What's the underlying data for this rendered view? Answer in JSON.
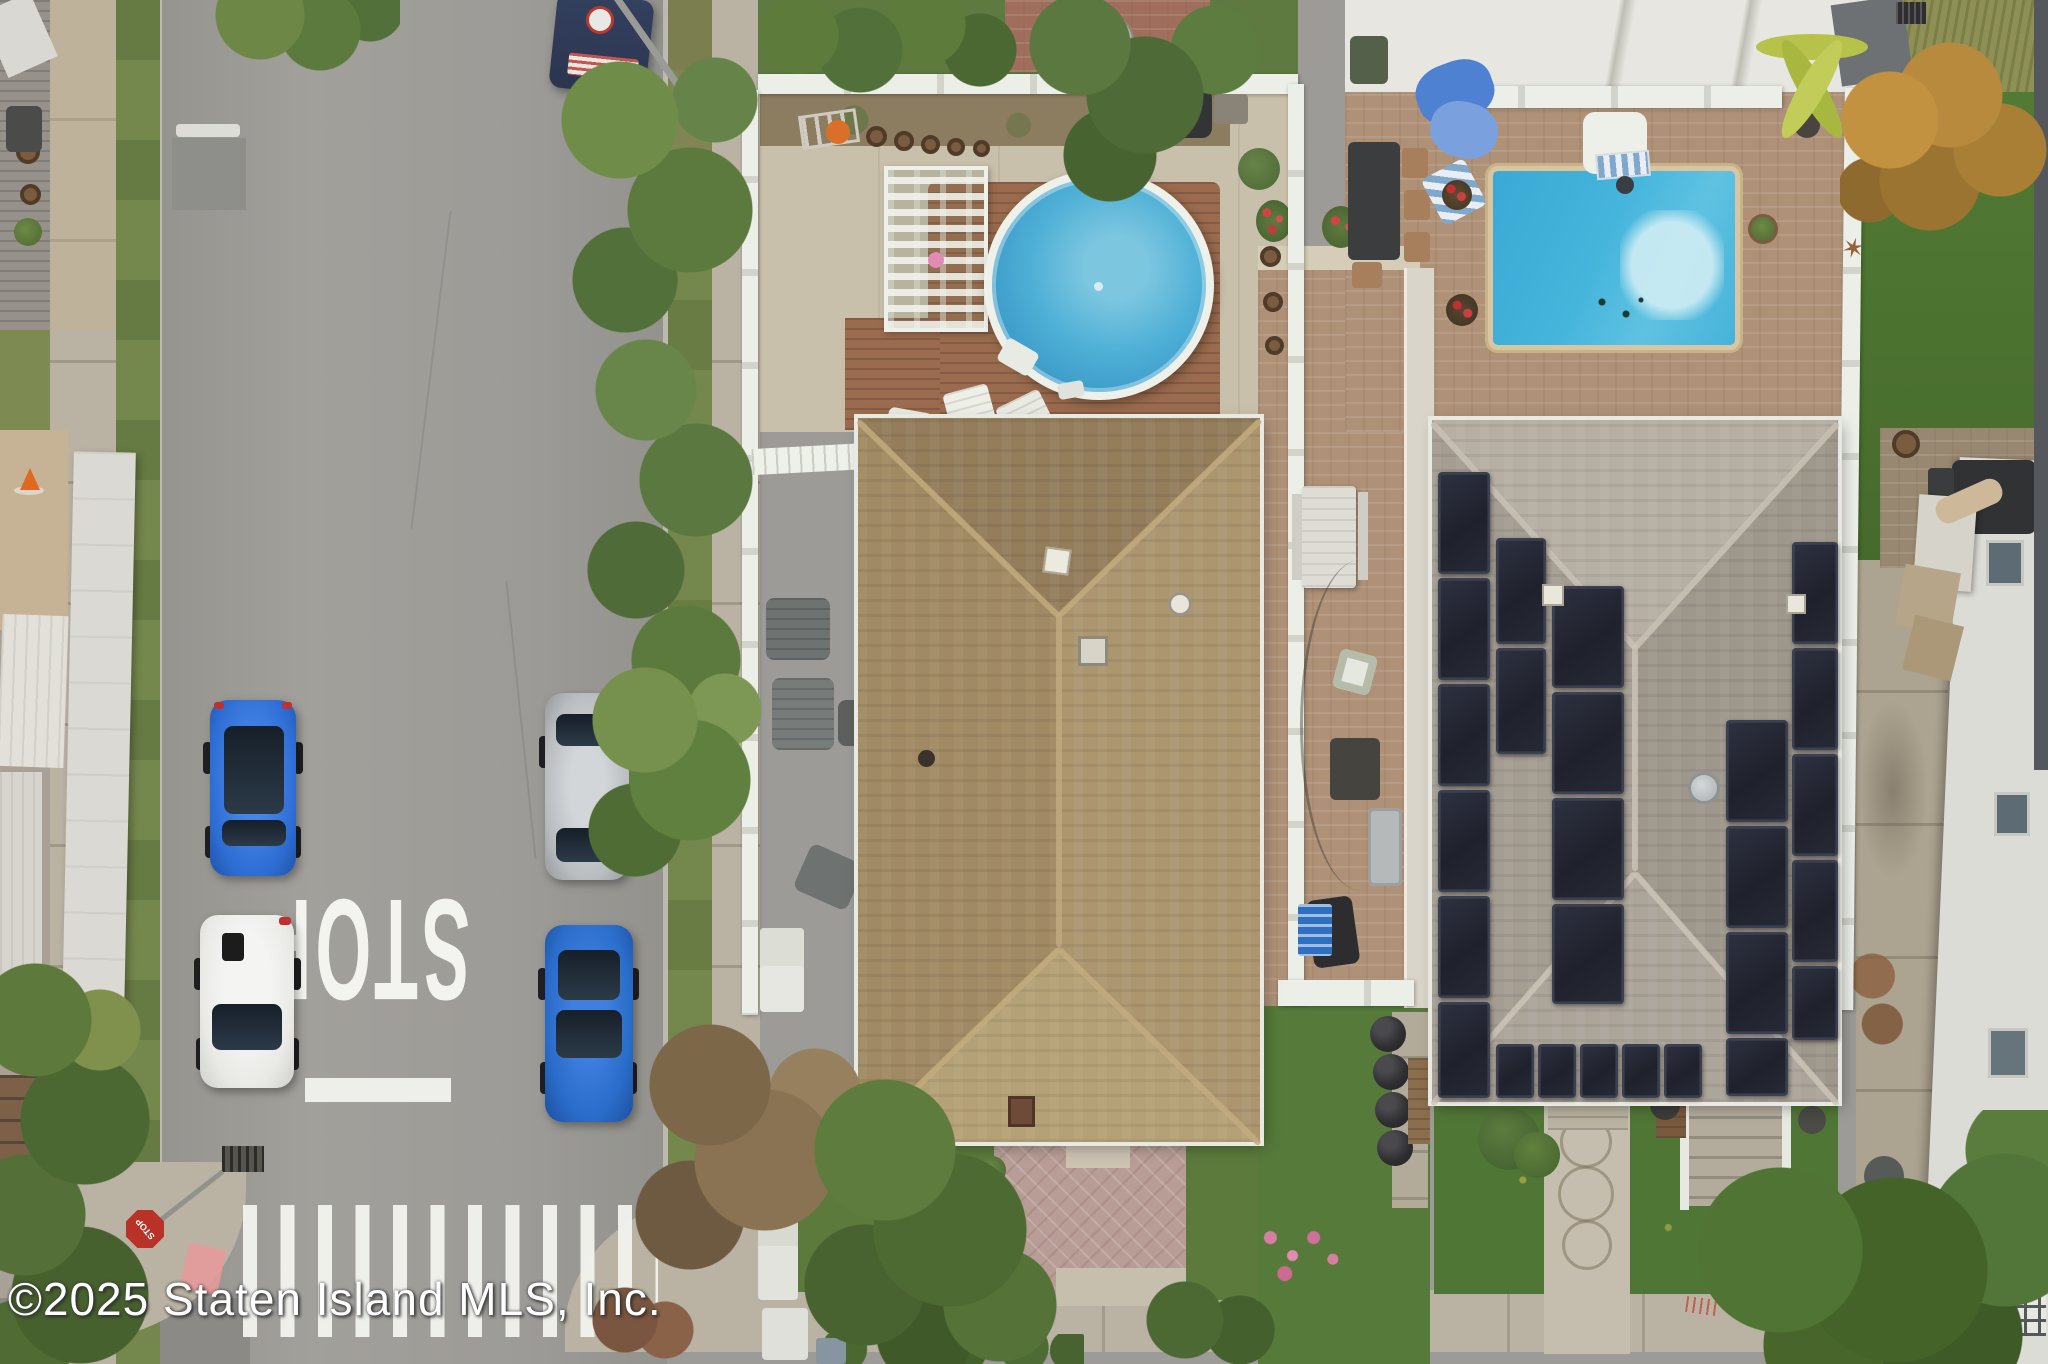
{
  "texts": {
    "watermark": "©2025 Staten Island MLS, Inc.",
    "road_marking": "STOP",
    "stop_sign_label": "STOP"
  },
  "colors": {
    "road": "#9c9b97",
    "road_dark": "#8b8a86",
    "sidewalk": "#bab3a4",
    "grass_strip": "#74874d",
    "lawn": "#4e7433",
    "concrete": "#c9c0ab",
    "paver_tan": "#ae9177",
    "paver_pink": "#b79d95",
    "deck_brown": "#9a6b4e",
    "fence_white": "#eceee8",
    "pool_water": "#42aed6",
    "roof_center_tan": "#a38d67",
    "roof_right_gray": "#a8a196",
    "solar_dark": "#262a33",
    "car_blue": "#2e6ed4",
    "car_blue2": "#2a6cc9",
    "car_white": "#e9e9e6",
    "car_silver": "#b9bdbf",
    "van_navy": "#2b3550",
    "stop_sign_red": "#b83227",
    "pink_paint": "#e59a9a",
    "stripe_white": "#f2f2ee",
    "watermark_white": "#fdfdfd"
  },
  "scene": {
    "type": "aerial drone photograph, top-down",
    "subject": "residential block with two houses, above-ground round pool, in-ground rectangular pool, solar-panel roof, street with parked cars, STOP road marking and crosswalk",
    "parked_vehicles": [
      "navy service van",
      "blue hatchback",
      "white hatchback",
      "silver sedan under tree",
      "blue sedan"
    ],
    "road_features": [
      "STOP painted upside down",
      "white stop line",
      "zebra crosswalk",
      "stop sign seen from above",
      "pink painted curb patches"
    ],
    "center_property": [
      "tan shingle hip roof",
      "round above-ground pool with wood deck",
      "white pergola",
      "white vinyl fences",
      "brick paver patio",
      "front paver driveway"
    ],
    "right_property": [
      "gray shingle hip roof with solar panel arrays",
      "in-ground pool with basketball hoop",
      "tan brick paver pool patio",
      "outdoor dining set",
      "front walkway with circle medallions"
    ],
    "far_right": [
      "neighbor lawn",
      "autumn orange tree",
      "white roof house",
      "trash cans",
      "rear patio with umbrella"
    ]
  }
}
